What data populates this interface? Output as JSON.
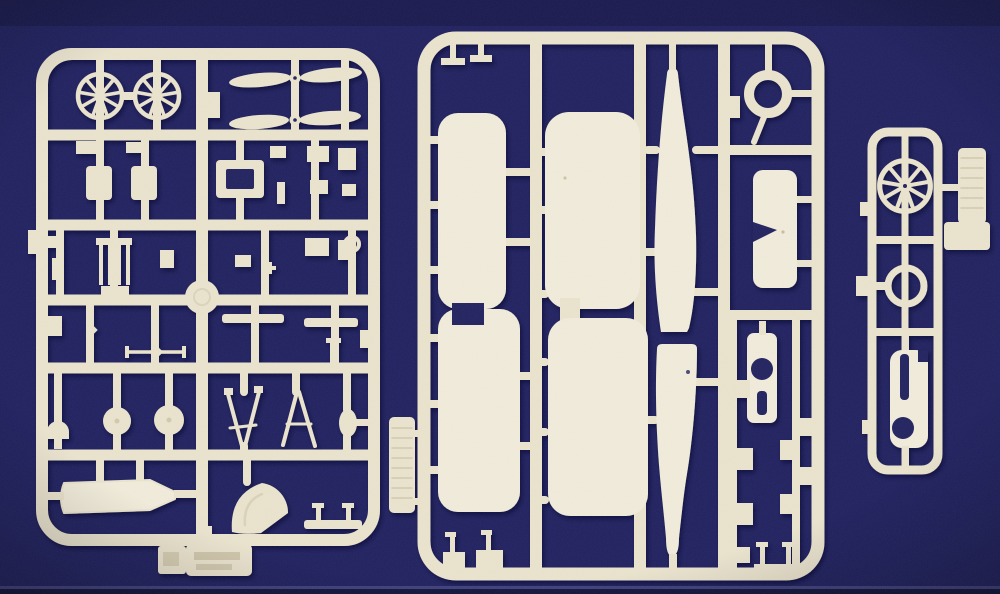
{
  "scene": {
    "description": "Photograph of three cream-coloured injection-moulded polystyrene sprues (model aircraft kit part frames) laid on a dark navy background",
    "colors": {
      "bg": "#20215f",
      "bg-top": "#191a4e",
      "bg-line": "#5a5b96",
      "bg-deep": "#14153d",
      "sprue": "#e8e1cc",
      "sprue-light": "#efe9d8",
      "sprue-dark": "#b4a988",
      "shadow": "#000028"
    },
    "sprues": [
      {
        "name": "left-detail-sprue",
        "parts": [
          "radial engine x2",
          "two-blade propeller x2",
          "cylinder blocks",
          "ladder frame",
          "round disc",
          "wheels x2",
          "headrest dome",
          "tapered fairing",
          "landing-gear V-strut x2",
          "cowling quarter",
          "small fittings",
          "embossed maker tab"
        ]
      },
      {
        "name": "main-airframe-sprue",
        "parts": [
          "wing half x4",
          "fuselage half x2",
          "cowling ring",
          "tailplane with notch",
          "turtle-deck with cockpit opening",
          "radiator block",
          "small fittings"
        ]
      },
      {
        "name": "small-engine-sprue",
        "parts": [
          "radial engine",
          "cowling ring",
          "engine cowl",
          "radiator block",
          "side tab"
        ]
      }
    ]
  }
}
